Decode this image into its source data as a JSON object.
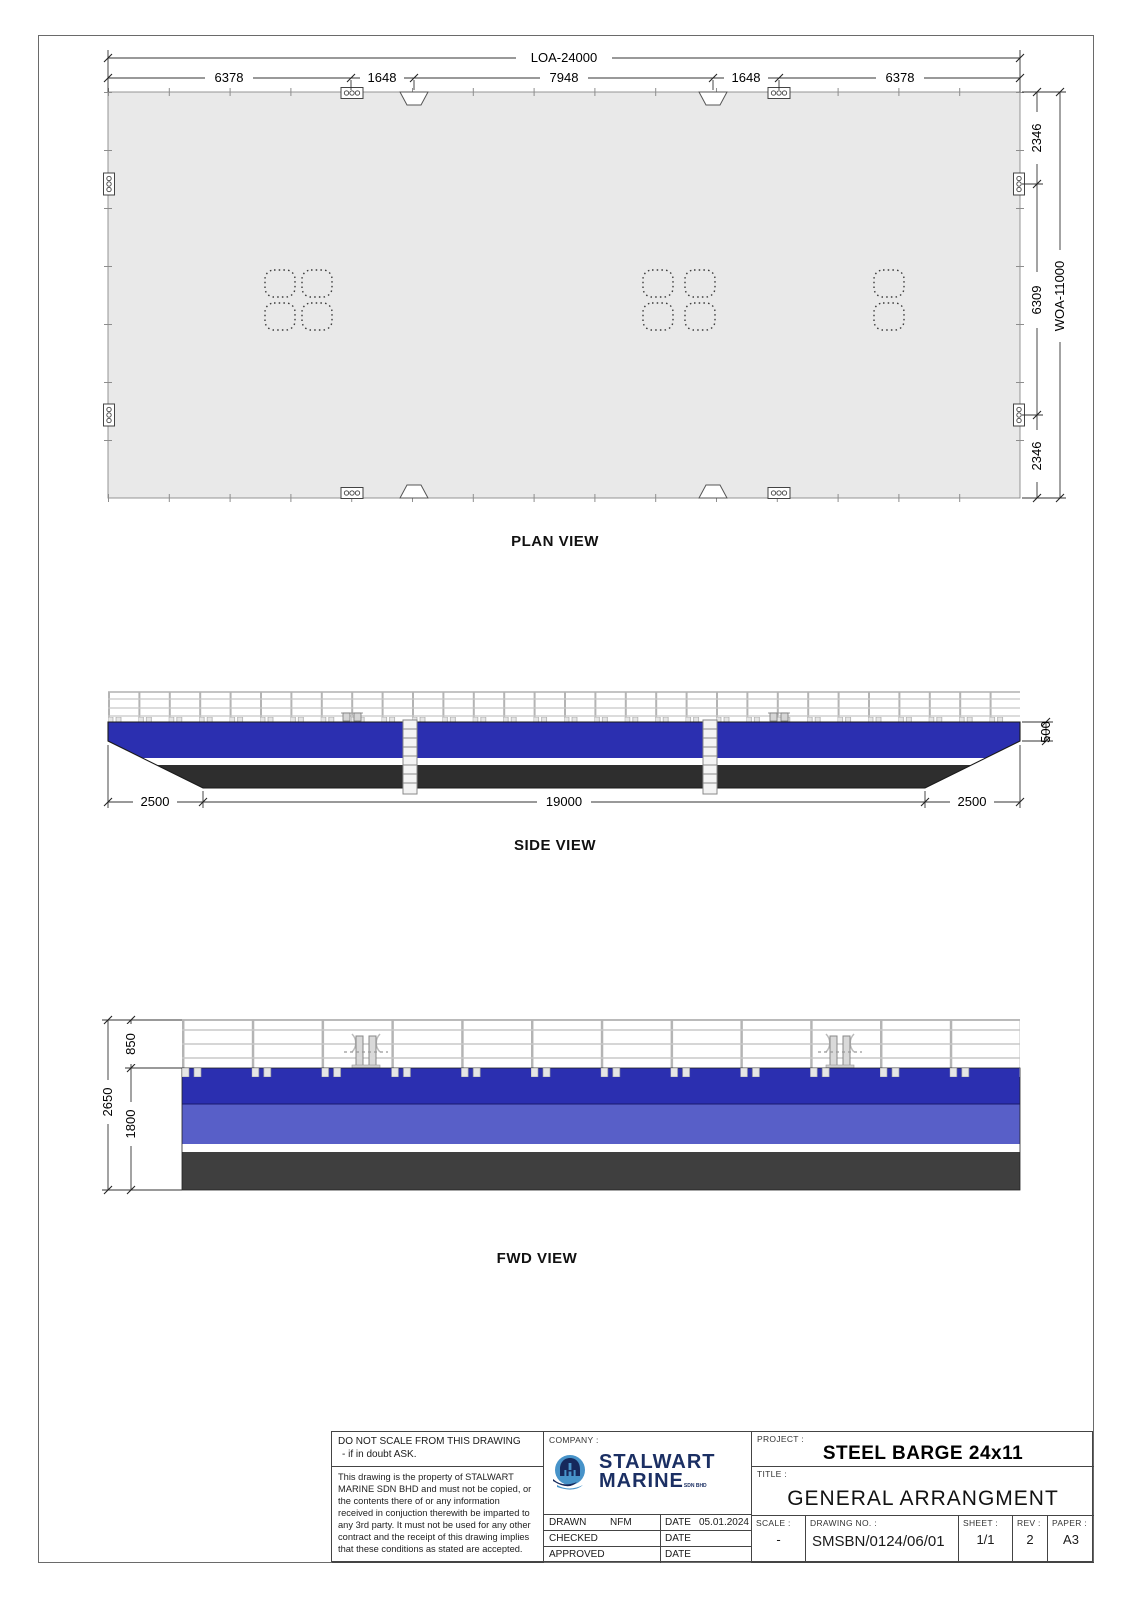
{
  "drawing": {
    "views": {
      "plan": {
        "label": "PLAN VIEW",
        "dim_loa": "LOA-24000",
        "dim_woa": "WOA-11000",
        "top_segments": [
          "6378",
          "1648",
          "7948",
          "1648",
          "6378"
        ],
        "side_segments": [
          "2346",
          "6309",
          "2346"
        ]
      },
      "side": {
        "label": "SIDE VIEW",
        "dim_left_rake": "2500",
        "dim_bottom": "19000",
        "dim_right_rake": "2500",
        "dim_end_depth": "500"
      },
      "fwd": {
        "label": "FWD VIEW",
        "dim_rail_height": "850",
        "dim_hull_depth": "1800",
        "dim_total_height": "2650"
      }
    },
    "colors": {
      "deck": "#e9e9e9",
      "hull_blue": "#2b2fb0",
      "hull_blue_light": "#585fc8",
      "stripe": "#ffffff",
      "hull_dark": "#2e2e2e",
      "fwd_dark": "#3f3f3f",
      "logo_light_blue": "#4793c9",
      "logo_navy": "#16295c"
    }
  },
  "title_block": {
    "note_scale_1": "DO NOT SCALE FROM THIS DRAWING",
    "note_scale_2": "- if in doubt ASK.",
    "note_property": "This drawing is the property of STALWART MARINE SDN BHD and must not be copied, or the contents there of or any information received in conjuction therewith be imparted to any 3rd party. It must not be used for any other contract and the receipt of this drawing implies that these conditions as stated are accepted.",
    "company": {
      "label": "COMPANY :",
      "name_line1": "STALWART",
      "name_line2": "MARINE",
      "suffix": "SDN BHD"
    },
    "approval_rows": [
      {
        "role": "DRAWN",
        "name": "NFM",
        "date_label": "DATE",
        "date": "05.01.2024"
      },
      {
        "role": "CHECKED",
        "name": "",
        "date_label": "DATE",
        "date": ""
      },
      {
        "role": "APPROVED",
        "name": "",
        "date_label": "DATE",
        "date": ""
      }
    ],
    "project": {
      "label": "PROJECT :",
      "value": "STEEL BARGE 24x11"
    },
    "title": {
      "label": "TITLE :",
      "value": "GENERAL ARRANGMENT"
    },
    "scale": {
      "label": "SCALE :",
      "value": "-"
    },
    "drawing_no": {
      "label": "DRAWING NO. :",
      "value": "SMSBN/0124/06/01"
    },
    "sheet": {
      "label": "SHEET :",
      "value": "1/1"
    },
    "rev": {
      "label": "REV :",
      "value": "2"
    },
    "paper": {
      "label": "PAPER :",
      "value": "A3"
    }
  }
}
